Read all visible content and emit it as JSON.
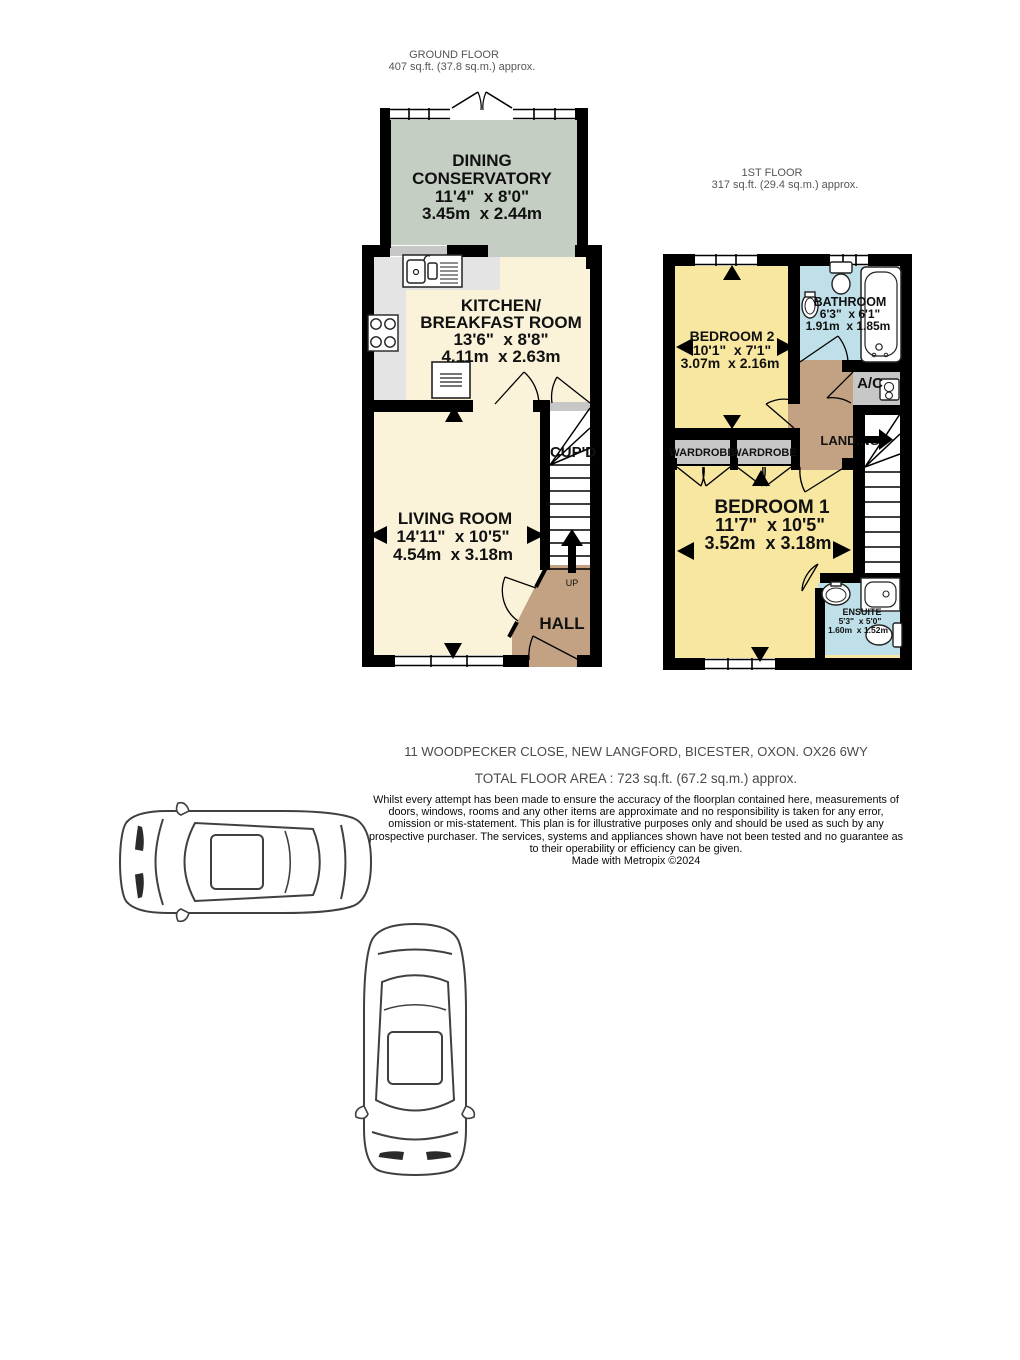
{
  "colors": {
    "wall": "#000000",
    "cream": "#faf3da",
    "sage": "#c4cec2",
    "yellow": "#f8e7a1",
    "blue": "#bfe0e8",
    "tan": "#c3a284",
    "gray": "#c7c7c7",
    "counter": "#e4e4e4",
    "white": "#ffffff"
  },
  "ground_floor": {
    "title": "GROUND FLOOR",
    "area": "407 sq.ft. (37.8 sq.m.) approx.",
    "dining": {
      "name1": "DINING",
      "name2": "CONSERVATORY",
      "imperial": "11'4\"  x 8'0\"",
      "metric": "3.45m  x 2.44m"
    },
    "kitchen": {
      "name1": "KITCHEN/",
      "name2": "BREAKFAST ROOM",
      "imperial": "13'6\"  x 8'8\"",
      "metric": "4.11m  x 2.63m"
    },
    "living": {
      "name": "LIVING ROOM",
      "imperial": "14'11\"  x 10'5\"",
      "metric": "4.54m  x 3.18m"
    },
    "hall": "HALL",
    "cupboard": "CUP'D",
    "up": "UP"
  },
  "first_floor": {
    "title": "1ST FLOOR",
    "area": "317 sq.ft. (29.4 sq.m.) approx.",
    "bedroom2": {
      "name": "BEDROOM 2",
      "imperial": "10'1\"  x 7'1\"",
      "metric": "3.07m  x 2.16m"
    },
    "bathroom": {
      "name": "BATHROOM",
      "imperial": "6'3\"  x 6'1\"",
      "metric": "1.91m  x 1.85m"
    },
    "bedroom1": {
      "name": "BEDROOM 1",
      "imperial": "11'7\"  x 10'5\"",
      "metric": "3.52m  x 3.18m"
    },
    "ensuite": {
      "name": "ENSUITE",
      "imperial": "5'3\"  x 5'0\"",
      "metric": "1.60m  x 1.52m"
    },
    "landing": "LANDING",
    "wardrobe_left": "WARDROBE",
    "wardrobe_right": "WARDROBE",
    "airing_cupboard": "A/C"
  },
  "icons": {
    "kitchen": [
      "sink-unit",
      "hob",
      "oven"
    ],
    "bathroom": [
      "toilet",
      "basin",
      "bathtub"
    ],
    "ensuite": [
      "basin",
      "shower",
      "toilet"
    ],
    "airing_cupboard": [
      "boiler"
    ],
    "illustrations": [
      "car-top-view-horizontal",
      "car-top-view-vertical"
    ]
  },
  "footer": {
    "address": "11 WOODPECKER CLOSE, NEW LANGFORD, BICESTER, OXON. OX26 6WY",
    "total_area": "TOTAL FLOOR AREA : 723 sq.ft. (67.2 sq.m.) approx.",
    "disclaimer": "Whilst every attempt has been made to ensure the accuracy of the floorplan contained here, measurements of doors, windows, rooms and any other items are approximate and no responsibility is taken for any error, omission or mis-statement. This plan is for illustrative purposes only and should be used as such by any prospective purchaser. The services, systems and appliances shown have not been tested and no guarantee as to their operability or efficiency can be given.",
    "credit": "Made with Metropix ©2024"
  }
}
